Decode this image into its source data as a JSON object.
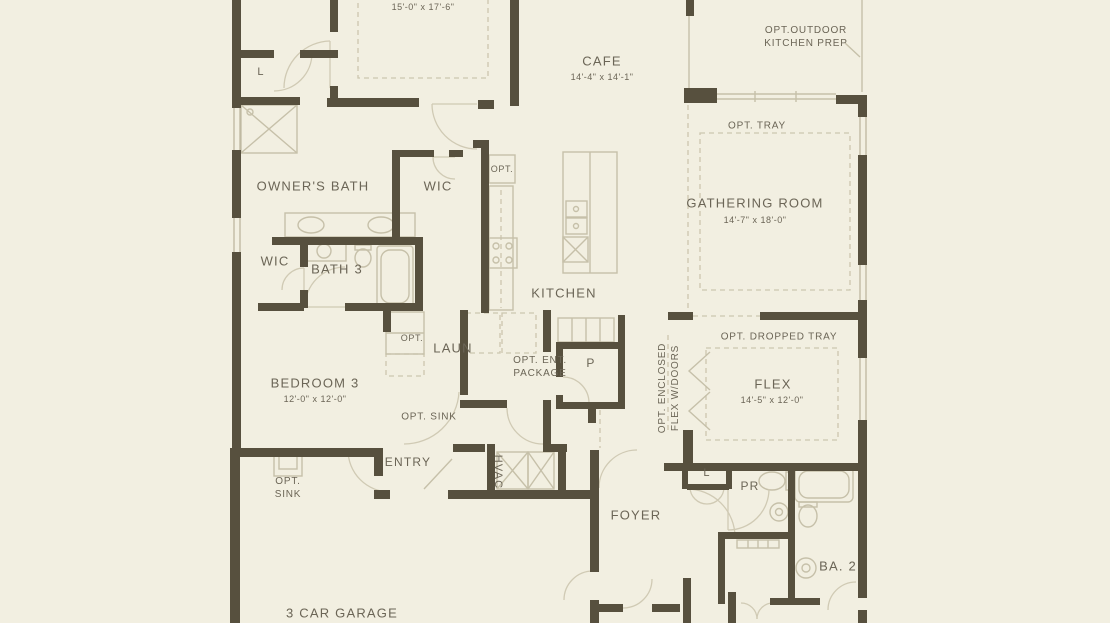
{
  "colors": {
    "background": "#f2efe1",
    "wall": "#57503e",
    "thin_line": "#c6c0a9",
    "text": "#6b6556"
  },
  "rooms": {
    "owner_suite": {
      "dims": "15'-0\" x 17'-6\""
    },
    "cafe": {
      "name": "CAFE",
      "dims": "14'-4\" x 14'-1\""
    },
    "gathering_room": {
      "name": "GATHERING ROOM",
      "dims": "14'-7\" x 18'-0\""
    },
    "owners_bath": {
      "name": "OWNER'S BATH"
    },
    "owners_wic": {
      "name": "WIC"
    },
    "wic_2": {
      "name": "WIC"
    },
    "bath_3": {
      "name": "BATH 3"
    },
    "kitchen": {
      "name": "KITCHEN"
    },
    "laundry": {
      "name": "LAUN"
    },
    "pantry": {
      "name": "P"
    },
    "bedroom_3": {
      "name": "BEDROOM 3",
      "dims": "12'-0\" x 12'-0\""
    },
    "flex": {
      "name": "FLEX",
      "dims": "14'-5\" x 12'-0\""
    },
    "entry": {
      "name": "ENTRY"
    },
    "hvac": {
      "name": "HVAC"
    },
    "foyer": {
      "name": "FOYER"
    },
    "garage": {
      "name": "3 CAR GARAGE"
    },
    "linen_1": {
      "name": "L"
    },
    "linen_2": {
      "name": "L"
    },
    "powder_room": {
      "name": "PR"
    },
    "bath_2": {
      "name": "BA. 2"
    }
  },
  "options": {
    "outdoor_kitchen": "OPT.OUTDOOR\nKITCHEN PREP",
    "tray": "OPT. TRAY",
    "fridge": "OPT.",
    "bedroom3_closet": "OPT.",
    "ent_package": "OPT. ENT.\nPACKAGE",
    "dropped_tray": "OPT. DROPPED TRAY",
    "enclosed_flex": "OPT. ENCLOSED\nFLEX W/DOORS",
    "sink_hall": "OPT. SINK",
    "sink_garage": "OPT.\nSINK"
  }
}
